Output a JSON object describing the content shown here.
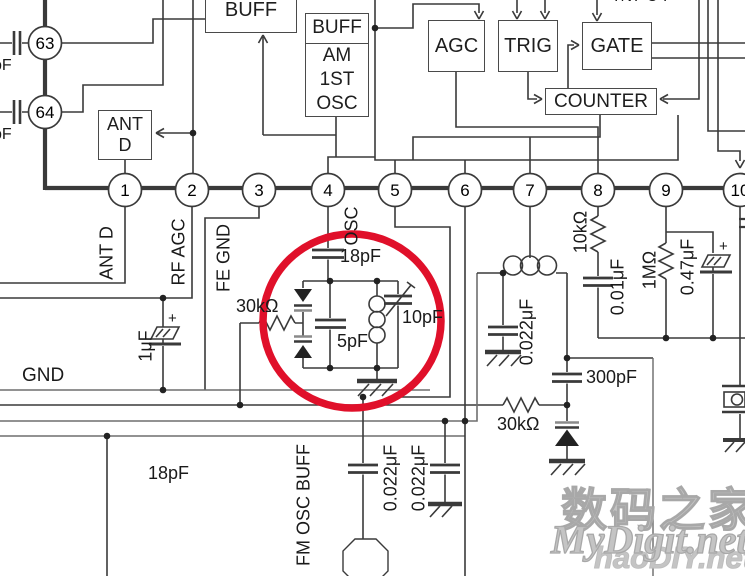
{
  "colors": {
    "wire": "#3a3a3a",
    "highlight": "#e0102a",
    "watermark_outline": "#a8a8a8"
  },
  "blocks": {
    "buff_top": "BUFF",
    "am_osc": {
      "l0": "BUFF",
      "l1": "AM",
      "l2": "1ST",
      "l3": "OSC"
    },
    "ant_d": {
      "l0": "ANT",
      "l1": "D"
    },
    "agc": "AGC",
    "trig": "TRIG",
    "gate": "GATE",
    "counter": "COUNTER",
    "input_label": "INPUT"
  },
  "pins": {
    "left": [
      "63",
      "64"
    ],
    "row": [
      "1",
      "2",
      "3",
      "4",
      "5",
      "6",
      "7",
      "8",
      "9",
      "10"
    ],
    "labels": {
      "pin1": "ANT D",
      "pin2": "RF AGC",
      "pin3": "FE GND",
      "pin4": "OSC"
    }
  },
  "left_caps": {
    "cap63": "pF",
    "cap64": "pF"
  },
  "labels": {
    "osc_cap": "18pF",
    "tank_res": "30kΩ",
    "tank_cap": "5pF",
    "trimmer_cap": "10pF",
    "pin7_cap": "0.022μF",
    "pin8_res": "10kΩ",
    "pin8_cap": "0.01μF",
    "pin9_res": "1MΩ",
    "pin9_cap": "0.47μF",
    "pin9_plus": "+",
    "cap_300": "300pF",
    "res_30k_bottom": "30kΩ",
    "cap_1u": "1μF",
    "cap_1u_plus": "+",
    "gnd": "GND",
    "cap_18_bottom": "18pF",
    "fm_osc_buff": "FM OSC BUFF",
    "buff_cap1": "0.022μF",
    "buff_cap2": "0.022μF"
  },
  "watermark": {
    "line1": "数码之家",
    "line2": "MyDigit.net",
    "line3": "haoDIY.net"
  }
}
